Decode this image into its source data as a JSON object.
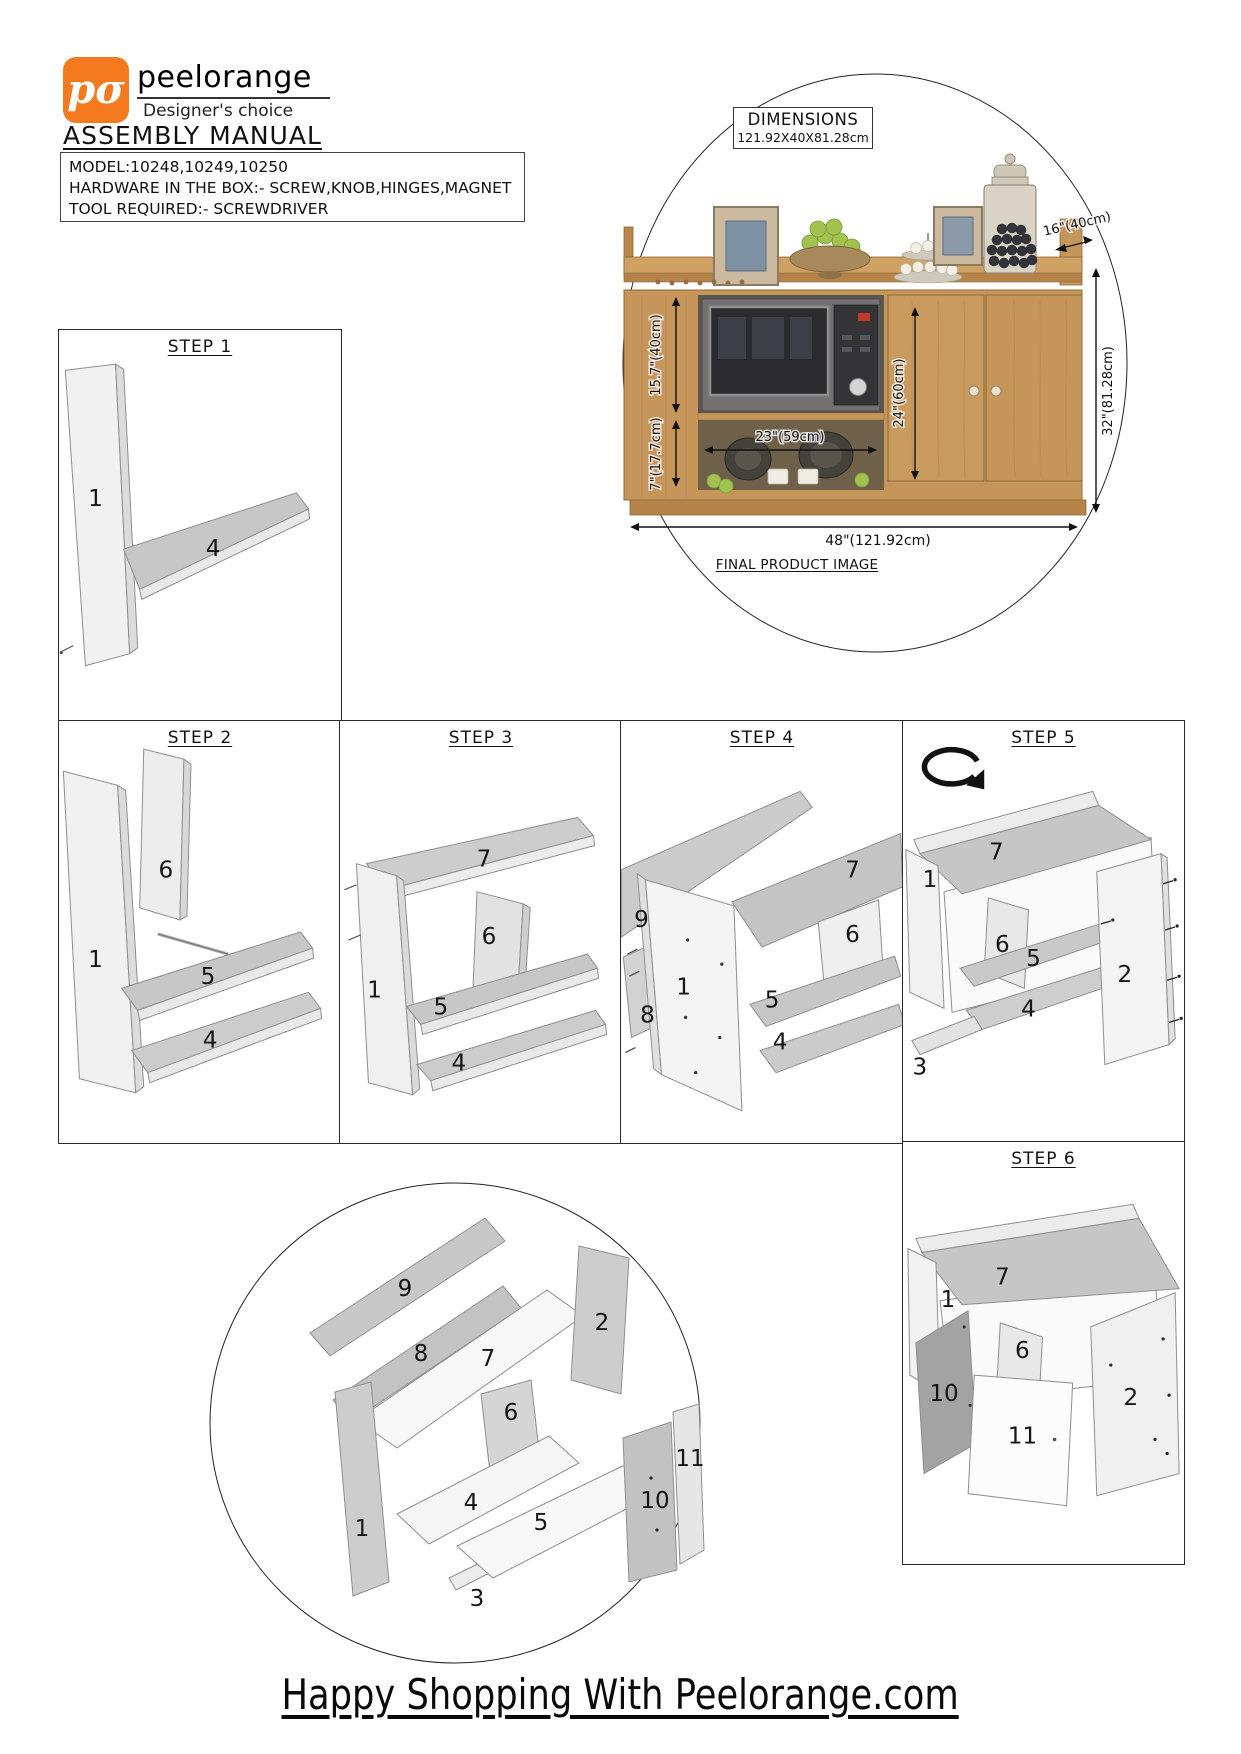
{
  "brand": {
    "logo_text": "pσ",
    "name": "peelorange",
    "tagline": "Designer's choice",
    "accent_color": "#F4791F"
  },
  "header": {
    "title": "ASSEMBLY MANUAL"
  },
  "info_box": {
    "model": "MODEL:10248,10249,10250",
    "hardware": "HARDWARE IN THE BOX:- SCREW,KNOB,HINGES,MAGNET",
    "tool": "TOOL REQUIRED:- SCREWDRIVER"
  },
  "product": {
    "dimensions_label": "DIMENSIONS",
    "dimensions_value": "121.92X40X81.28cm",
    "caption": "FINAL PRODUCT IMAGE",
    "dims": {
      "top_depth": "16\"(40cm)",
      "upper_section_height": "15.7\"(40cm)",
      "lower_section_height": "7\"(17.7cm)",
      "open_shelf_width": "23\"(59cm)",
      "door_section_height": "24\"(60cm)",
      "overall_height": "32\"(81.28cm)",
      "overall_width": "48\"(121.92cm)"
    }
  },
  "steps": [
    {
      "title": "STEP 1",
      "labels": {
        "p1": "1",
        "p4": "4"
      }
    },
    {
      "title": "STEP 2",
      "labels": {
        "p1": "1",
        "p4": "4",
        "p5": "5",
        "p6": "6"
      }
    },
    {
      "title": "STEP 3",
      "labels": {
        "p1": "1",
        "p4": "4",
        "p5": "5",
        "p6": "6",
        "p7": "7"
      }
    },
    {
      "title": "STEP 4",
      "labels": {
        "p1": "1",
        "p4": "4",
        "p5": "5",
        "p6": "6",
        "p7": "7",
        "p8": "8",
        "p9": "9"
      }
    },
    {
      "title": "STEP 5",
      "labels": {
        "p1": "1",
        "p2": "2",
        "p3": "3",
        "p4": "4",
        "p5": "5",
        "p6": "6",
        "p7": "7"
      }
    },
    {
      "title": "STEP 6",
      "labels": {
        "p1": "1",
        "p2": "2",
        "p6": "6",
        "p7": "7",
        "p10": "10",
        "p11": "11"
      }
    }
  ],
  "exploded": {
    "labels": {
      "p1": "1",
      "p2": "2",
      "p3": "3",
      "p4": "4",
      "p5": "5",
      "p6": "6",
      "p7": "7",
      "p8": "8",
      "p9": "9",
      "p10": "10",
      "p11": "11"
    }
  },
  "footer": {
    "text": "Happy Shopping With Peelorange.com"
  }
}
